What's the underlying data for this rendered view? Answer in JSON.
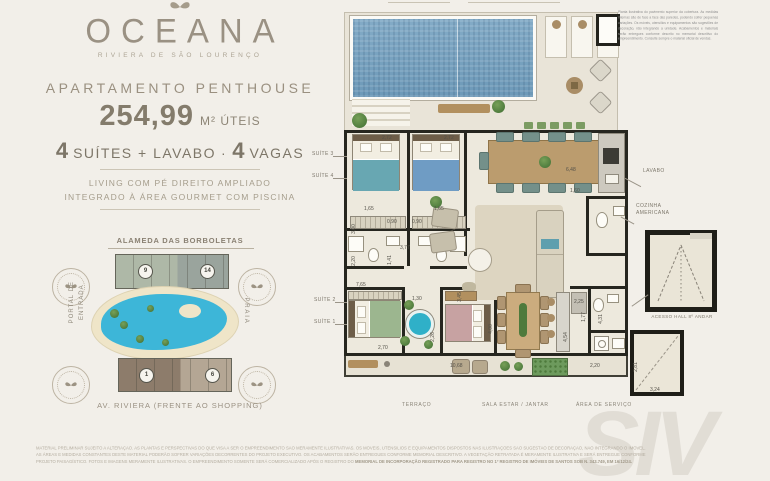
{
  "brand": {
    "logo": "OCEANA",
    "tagline": "RIVIERA DE SÃO LOURENÇO"
  },
  "listing": {
    "category": "APARTAMENTO PENTHOUSE",
    "area_value": "254,99",
    "area_unit": "M² ÚTEIS",
    "f1_num": "4",
    "f1_label": "SUÍTES + LAVABO",
    "dot": "·",
    "f2_num": "4",
    "f2_label": "VAGAS",
    "highlight_line1": "LIVING COM PÉ DIREITO AMPLIADO",
    "highlight_line2": "INTEGRADO À ÁREA GOURMET COM PISCINA"
  },
  "sitemap": {
    "top_label": "ALAMEDA DAS BORBOLETAS",
    "left_label1": "PORTAL DE",
    "left_label2": "ENTRADA",
    "right_label": "PRAIA",
    "bottom_label": "AV. RIVIERA (FRENTE AO SHOPPING)",
    "top_building": {
      "left_num": "9",
      "right_num": "14"
    },
    "bottom_building": {
      "left_num": "1",
      "right_num": "6"
    }
  },
  "floorplan": {
    "room_labels": {
      "suite3": "SUÍTE 3",
      "suite4": "SUÍTE 4",
      "suite2": "SUÍTE 2",
      "suite1": "SUÍTE 1",
      "lavabo": "LAVABO",
      "cozinha1": "COZINHA",
      "cozinha2": "AMERICANA",
      "acesso_hall": "ACESSO HALL 8º ANDAR",
      "terraco": "TERRAÇO",
      "sala": "SALA ESTAR / JANTAR",
      "servico": "ÁREA DE SERVIÇO"
    },
    "dims": {
      "suite3_w": "2,72",
      "suite4_w": "2,72",
      "bath3_w": "1,65",
      "bath4_w": "1,65",
      "hall3_w": "0,90",
      "hall4_w": "0,90",
      "corridor_w": "3,77",
      "corridor_h": "1,41",
      "suite3_d": "3,00",
      "left_h": "2,20",
      "suite2_l": "7,65",
      "suite2_w": "2,70",
      "closet_w": "1,30",
      "bath1_h": "2,26",
      "suite1_h": "3,45",
      "sala_h": "4,00",
      "terraco_w": "10,68",
      "gourmet_w": "6,48",
      "lavabo_w": "1,60",
      "cozinha_w": "2,25",
      "wc_h": "1,77",
      "coz_h": "4,31",
      "island_h": "4,54",
      "serv_w": "2,20",
      "hall_h": "2,81",
      "hall_w": "3,24"
    }
  },
  "notes": {
    "corner_note": "Planta ilustrativa do pavimento superior da cobertura. As medidas internas são de face a face das paredes, podendo sofrer pequenas variações. Os móveis, utensílios e equipamentos são sugestões de decoração, não integrando a unidade. Acabamentos e materiais serão entregues conforme descrito no memorial descritivo do empreendimento. Consulte sempre o material oficial de vendas.",
    "disclaimer": "MATERIAL PRELIMINAR SUJEITO A ALTERAÇÃO. AS PLANTAS E PERSPECTIVAS DO QUE VISA A SER O EMPREENDIMENTO SÃO MERAMENTE ILUSTRATIVAS. OS MÓVEIS, UTENSÍLIOS E EQUIPAMENTOS DISPOSTOS NAS ILUSTRAÇÕES SÃO SUGESTÃO DE DECORAÇÃO, NÃO INTEGRANDO O IMÓVEL. AS ÁREAS E MEDIDAS CONSTANTES DESTE MATERIAL PODERÃO SOFRER VARIAÇÕES DECORRENTES DO PROJETO EXECUTIVO. OS ACABAMENTOS SERÃO ENTREGUES CONFORME MEMORIAL DESCRITIVO. A VEGETAÇÃO RETRATADA É MERAMENTE ILUSTRATIVA E SERÁ ENTREGUE CONFORME PROJETO PAISAGÍSTICO. FOTOS E IMAGENS MERAMENTE ILUSTRATIVAS. O EMPREENDIMENTO SOMENTE SERÁ COMERCIALIZADO APÓS O REGISTRO DO ",
    "disclaimer_bold": "MEMORIAL DE INCORPORAÇÃO REGISTRADO PARA REGISTRO NO 1º REGISTRO DE IMÓVEIS DE SANTOS SOB N. 343.749, EM 16/12/24.",
    "watermark": "SIV"
  }
}
